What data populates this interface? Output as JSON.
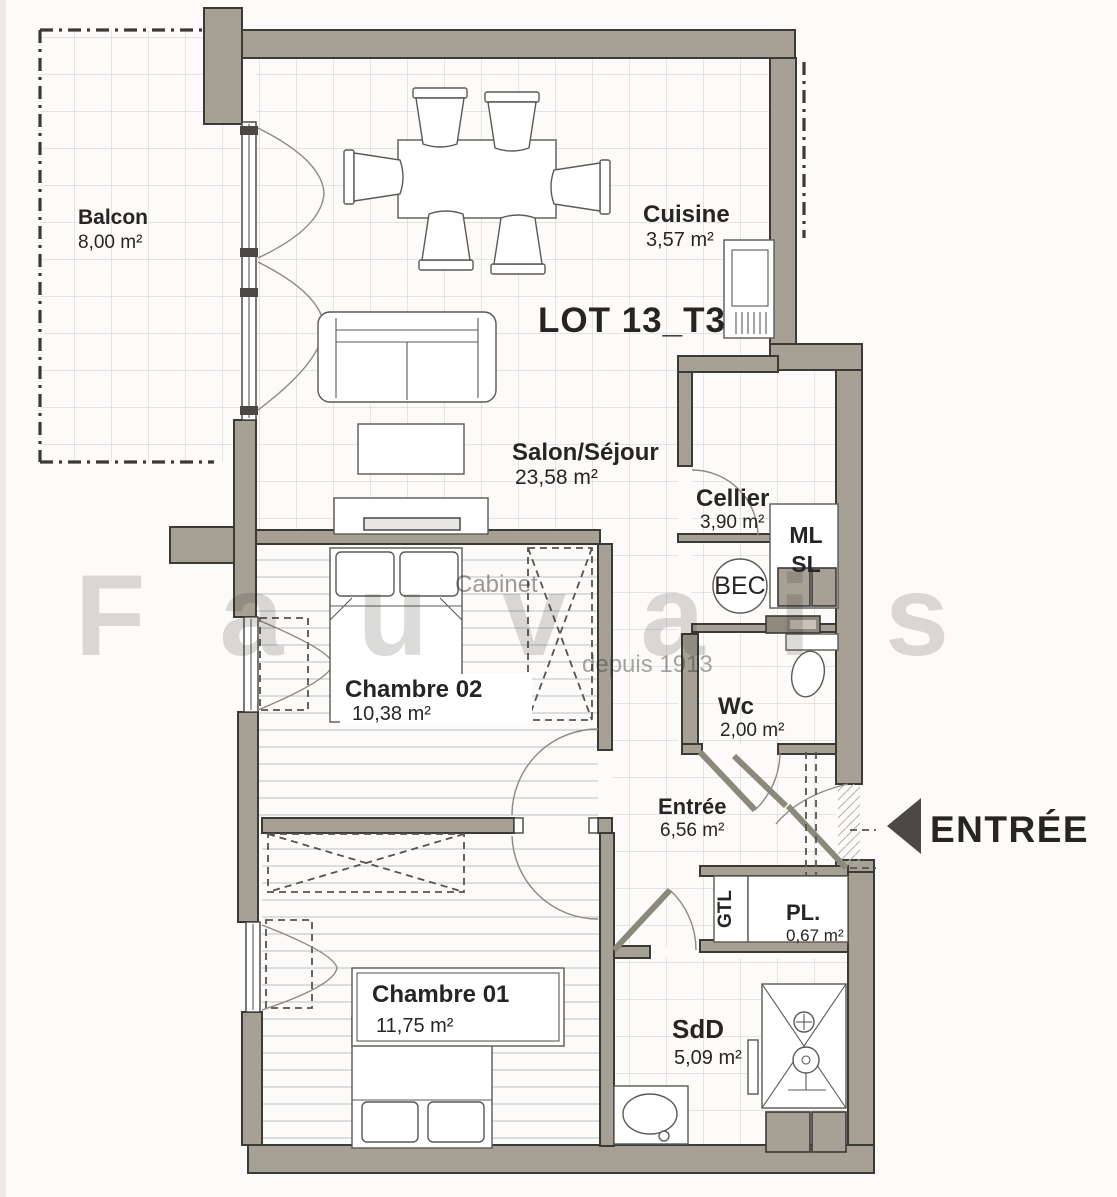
{
  "plan": {
    "lot_title": "LOT 13_T3",
    "rooms": [
      {
        "name": "Balcon",
        "area": "8,00 m²"
      },
      {
        "name": "Cuisine",
        "area": "3,57 m²"
      },
      {
        "name": "Salon/Séjour",
        "area": "23,58 m²"
      },
      {
        "name": "Cellier",
        "area": "3,90 m²"
      },
      {
        "name": "Chambre 02",
        "area": "10,38 m²"
      },
      {
        "name": "Wc",
        "area": "2,00 m²"
      },
      {
        "name": "Entrée",
        "area": "6,56 m²"
      },
      {
        "name": "Chambre 01",
        "area": "11,75 m²"
      },
      {
        "name": "PL.",
        "area": "0,67 m²"
      },
      {
        "name": "SdD",
        "area": "5,09 m²"
      }
    ],
    "fixtures": {
      "ml": "ML",
      "sl": "SL",
      "bec": "BEC",
      "gtl": "GTL"
    },
    "entry": {
      "label": "ENTRÉE"
    },
    "watermark": {
      "line1": "Cabinet",
      "line2": "Fauvais",
      "line3": "depuis 1913"
    },
    "colors": {
      "wall": "#a7a094",
      "outline": "#3b3a37",
      "text": "#262523",
      "arrow": "#4b4945",
      "grid": "#cbccce",
      "plank": "#bdbfc2"
    }
  }
}
